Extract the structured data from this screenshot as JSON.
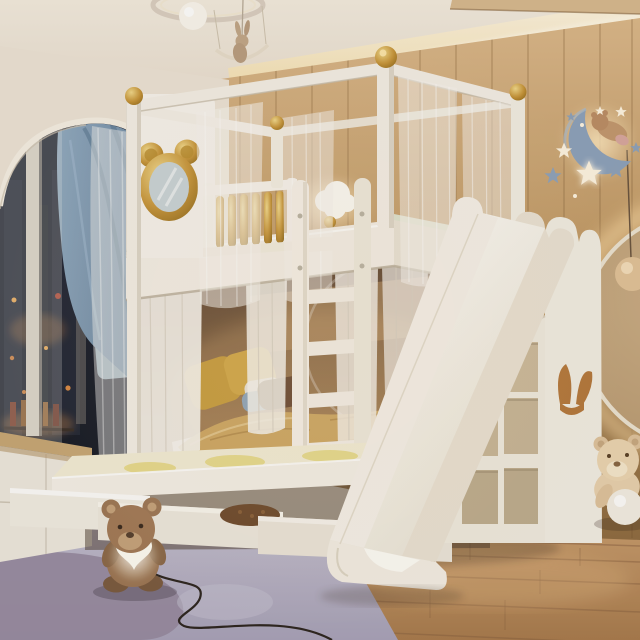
{
  "scene": {
    "type": "interior-photo",
    "subject": "children bedroom with white bunk bed, slide and trundle bed",
    "lighting": "warm evening ambient with cove lighting",
    "objects": [
      {
        "name": "ceiling-pendant-light",
        "detail": "ring lamp with globe and bunny on swing"
      },
      {
        "name": "arched-alcove",
        "detail": "night window, bottle shelf, blue velvet curtain, sheer curtains"
      },
      {
        "name": "wood-panel-wall",
        "detail": "vertical oak planks with cove light"
      },
      {
        "name": "moon-decor",
        "detail": "blue crescent moon with sleeping teddy bear"
      },
      {
        "name": "star-decor",
        "detail": "glowing white stars and blue stars"
      },
      {
        "name": "round-backlit-mirror",
        "detail": "large circle mirror with warm halo and sphere pendant"
      },
      {
        "name": "bunk-bed",
        "detail": "white canopy bed, gold ball finials, mickey mirror headboard, gold spindle railing"
      },
      {
        "name": "mickey-mirror",
        "detail": "gold mouse-ears framed mirror on headboard"
      },
      {
        "name": "ladder",
        "detail": "white five-rung ladder"
      },
      {
        "name": "lower-bunk",
        "detail": "mustard, brown and blue pillows with golden duvet"
      },
      {
        "name": "trundle-bed",
        "detail": "pulled-out platform with yellow patterned mattress and three drawers"
      },
      {
        "name": "slide",
        "detail": "white cloud-scalloped slide to floor"
      },
      {
        "name": "cubby-storage",
        "detail": "staircase shelf unit with open cubbies"
      },
      {
        "name": "cabinet-rabbit-handle",
        "detail": "white cabinet with wooden bunny-ear handle"
      },
      {
        "name": "window-dresser",
        "detail": "white dresser with wood sill under window"
      },
      {
        "name": "rug",
        "detail": "lavender rug with mauve blob pattern"
      },
      {
        "name": "teddy-bear-lamp",
        "detail": "brown bear holding glowing heart, cord on rug"
      },
      {
        "name": "floor-teddy-bear",
        "detail": "beige bear with white ball near wall"
      }
    ]
  },
  "palette": {
    "cream-wall": "#ede4d6",
    "ceiling-hi": "#f4ecdf",
    "ceiling-lo": "#e9dfd0",
    "cove-glow": "#fff3d6",
    "wood-hi": "#dcb98b",
    "wood-mid": "#c19a66",
    "wood-lo": "#9a7647",
    "floor-hi": "#cb9f70",
    "floor-lo": "#a97c4e",
    "plank-line": "#8a6342",
    "night-sky": "#171b26",
    "city-glow": "#c98445",
    "blue-curtain-hi": "#93acc2",
    "blue-curtain-lo": "#5f7d99",
    "sheer": "#f7f4ef",
    "white-furn": "#f5f0e7",
    "white-shadow": "#ddd5c7",
    "gold-hi": "#f2d98a",
    "gold-mid": "#c8963a",
    "gold-lo": "#8f6717",
    "bunk-dark": "#5f4530",
    "bunk-warm": "#a07c54",
    "pillow-mustard": "#c89d3e",
    "pillow-brown": "#6a4a32",
    "pillow-white": "#e9e3d8",
    "pillow-blue": "#8fa6ba",
    "duvet": "#cfa863",
    "trundle-top": "#f4edd6",
    "mattress-pattern": "#e6d77c",
    "rug-hi": "#c0bccd",
    "rug-lo": "#a9a3ba",
    "rug-blob": "#978ba1",
    "moon": "#8ea3bd",
    "star-white": "#fff6e3",
    "star-blue": "#8fa3bc",
    "mirror-halo": "#ffdfa8",
    "mirror-face": "#b99a72",
    "bear-brown": "#9e7856",
    "bear-dark": "#7c5c40",
    "bear-muzzle": "#c6a37c",
    "bear-beige": "#e9d2af",
    "handle-wood": "#b5793c",
    "heart-glow": "#fffdf4",
    "cord": "#2d2620",
    "sage": "#dfe3cf",
    "cushion-blue": "#a9c1d2",
    "drawer-item": "#6e4a2c"
  }
}
